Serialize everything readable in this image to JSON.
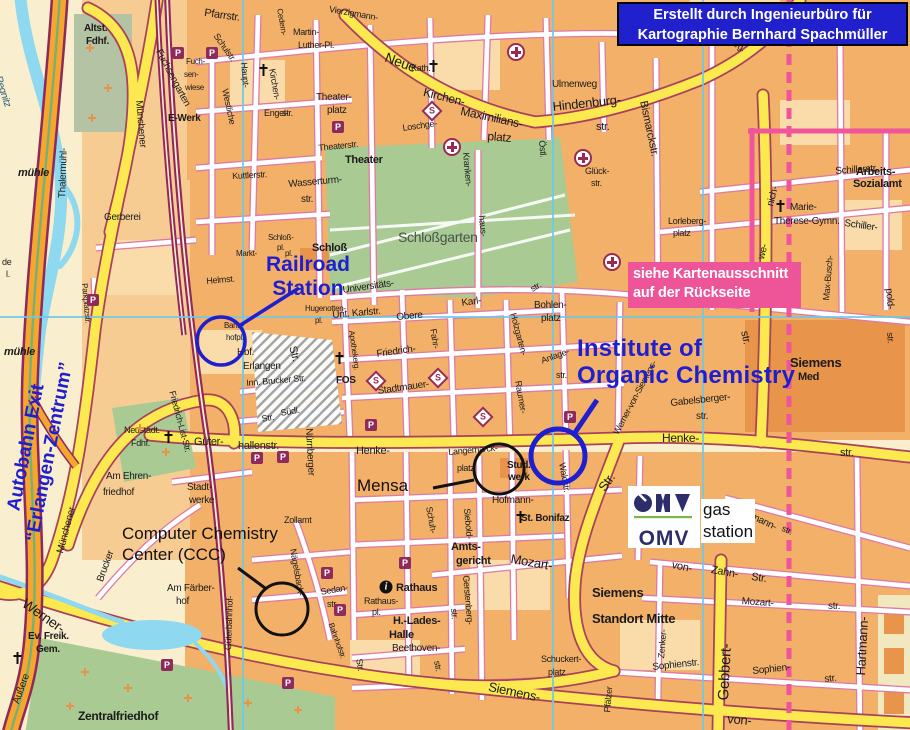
{
  "attribution": {
    "line1": "Erstellt durch Ingenieurbüro für",
    "line2": "Kartographie Bernhard Spachmüller"
  },
  "note": {
    "line1": "siehe Kartenausschnitt",
    "line2": "auf der Rückseite"
  },
  "annotations": {
    "railroad_station": {
      "line1": "Railroad",
      "line2": "Station"
    },
    "institute": {
      "line1": "Institute of",
      "line2": "Organic Chemistry"
    },
    "autobahn_exit": {
      "line1": "Autobahn Exit",
      "line2": "“Erlangen-Zentrum”"
    },
    "mensa": {
      "label": "Mensa"
    },
    "ccc": {
      "line1": "Computer Chemistry",
      "line2": "Center (CCC)"
    },
    "gas_station": {
      "line1": "gas",
      "line2": "station"
    },
    "omv": {
      "label": "OMV"
    }
  },
  "colors": {
    "annotation_blue": "#1F1FCF",
    "attribution_bg": "#2020CC",
    "note_pink": "#EE5598",
    "yellow_road": "#FBE94F",
    "block_orange": "#F3B068",
    "park_green": "#A9CB93",
    "river_blue": "#8ED9F0",
    "railway_maroon": "#93275C",
    "grid_blue": "#6EC9E9",
    "omv_navy": "#2D2D6B",
    "omv_green": "#7AB648"
  },
  "street_labels": [
    {
      "t": "Pfarrstr.",
      "x": 205,
      "y": 8,
      "s": 11,
      "r": 8
    },
    {
      "t": "Martin-",
      "x": 293,
      "y": 28,
      "s": 9
    },
    {
      "t": "Luther-Pl.",
      "x": 298,
      "y": 41,
      "s": 9
    },
    {
      "t": "Neue",
      "x": 388,
      "y": 50,
      "s": 14,
      "r": 20
    },
    {
      "t": "Vierzigmann-",
      "x": 330,
      "y": 5,
      "s": 9,
      "r": 10
    },
    {
      "t": "Cedern-",
      "x": 283,
      "y": 8,
      "s": 8,
      "r": 80
    },
    {
      "t": "Kath.",
      "x": 411,
      "y": 64,
      "s": 9
    },
    {
      "t": "Kirchen-",
      "x": 425,
      "y": 86,
      "s": 12,
      "r": 14
    },
    {
      "t": "Maximilians-",
      "x": 462,
      "y": 105,
      "s": 12,
      "r": 12
    },
    {
      "t": "platz",
      "x": 488,
      "y": 130,
      "s": 12,
      "r": 5
    },
    {
      "t": "Hindenburg-",
      "x": 552,
      "y": 100,
      "s": 13,
      "r": -6
    },
    {
      "t": "str.",
      "x": 596,
      "y": 122,
      "s": 11
    },
    {
      "t": "Ulmenweg",
      "x": 552,
      "y": 80,
      "s": 10
    },
    {
      "t": "Hinden-",
      "x": 688,
      "y": 22,
      "s": 9
    },
    {
      "t": "burg.",
      "x": 730,
      "y": 36,
      "s": 9,
      "r": 30
    },
    {
      "t": "Bismarckstr.",
      "x": 648,
      "y": 100,
      "s": 11,
      "r": 78
    },
    {
      "t": "Schillerstr.",
      "x": 835,
      "y": 167,
      "s": 10,
      "r": -4
    },
    {
      "t": "Arbeits-",
      "x": 856,
      "y": 167,
      "s": 11,
      "w": 700
    },
    {
      "t": "Sozialamt",
      "x": 853,
      "y": 179,
      "s": 11,
      "w": 700
    },
    {
      "t": "Schiller-",
      "x": 845,
      "y": 219,
      "s": 10,
      "r": 8
    },
    {
      "t": "Marie-",
      "x": 790,
      "y": 203,
      "s": 10
    },
    {
      "t": "Therese-Gymn.",
      "x": 774,
      "y": 217,
      "s": 10
    },
    {
      "t": "Lorleberg-",
      "x": 668,
      "y": 217,
      "s": 9
    },
    {
      "t": "platz",
      "x": 673,
      "y": 229,
      "s": 9
    },
    {
      "t": "Glück-",
      "x": 585,
      "y": 167,
      "s": 9
    },
    {
      "t": "str.",
      "x": 591,
      "y": 179,
      "s": 9
    },
    {
      "t": "Östl.",
      "x": 546,
      "y": 140,
      "s": 9,
      "r": 85
    },
    {
      "t": "Kranken-",
      "x": 470,
      "y": 152,
      "s": 9,
      "r": 85
    },
    {
      "t": "haus-",
      "x": 486,
      "y": 215,
      "s": 9,
      "r": 85
    },
    {
      "t": "Theater",
      "x": 345,
      "y": 155,
      "s": 11,
      "w": 700
    },
    {
      "t": "Theaterstr.",
      "x": 318,
      "y": 144,
      "s": 9,
      "r": -6
    },
    {
      "t": "Theater-",
      "x": 316,
      "y": 93,
      "s": 10
    },
    {
      "t": "platz",
      "x": 327,
      "y": 106,
      "s": 10
    },
    {
      "t": "Wasserturm-",
      "x": 288,
      "y": 180,
      "s": 10,
      "r": -5
    },
    {
      "t": "str.",
      "x": 301,
      "y": 195,
      "s": 10
    },
    {
      "t": "Kuttlerstr.",
      "x": 232,
      "y": 172,
      "s": 9,
      "r": -3
    },
    {
      "t": "Gerberei",
      "x": 104,
      "y": 213,
      "s": 10
    },
    {
      "t": "Schloßgarten",
      "x": 398,
      "y": 230,
      "s": 14,
      "c": "#47524a"
    },
    {
      "t": "Schloß",
      "x": 312,
      "y": 243,
      "s": 11,
      "w": 700
    },
    {
      "t": "Schloß-",
      "x": 268,
      "y": 234,
      "s": 8
    },
    {
      "t": "pl.",
      "x": 277,
      "y": 244,
      "s": 8
    },
    {
      "t": "Markt-",
      "x": 236,
      "y": 250,
      "s": 8
    },
    {
      "t": "pl.",
      "x": 285,
      "y": 250,
      "s": 8
    },
    {
      "t": "Helmst.",
      "x": 206,
      "y": 277,
      "s": 9,
      "r": -5
    },
    {
      "t": "Haupt-",
      "x": 248,
      "y": 62,
      "s": 9,
      "r": 85
    },
    {
      "t": "Kirchen-",
      "x": 276,
      "y": 68,
      "s": 9,
      "r": 80
    },
    {
      "t": "Engel-",
      "x": 264,
      "y": 109,
      "s": 9
    },
    {
      "t": "str.",
      "x": 282,
      "y": 109,
      "s": 9
    },
    {
      "t": "Schulstr.",
      "x": 219,
      "y": 32,
      "s": 9,
      "r": 55
    },
    {
      "t": "Westliche",
      "x": 229,
      "y": 88,
      "s": 9,
      "r": 78
    },
    {
      "t": "Fuchsengarten",
      "x": 162,
      "y": 48,
      "s": 10,
      "r": 62
    },
    {
      "t": "Fuch-",
      "x": 186,
      "y": 58,
      "s": 8
    },
    {
      "t": "sen-",
      "x": 184,
      "y": 71,
      "s": 8
    },
    {
      "t": "wiese",
      "x": 185,
      "y": 84,
      "s": 8
    },
    {
      "t": "E-Werk",
      "x": 168,
      "y": 114,
      "s": 10,
      "w": 700
    },
    {
      "t": "Altst.",
      "x": 84,
      "y": 24,
      "s": 10,
      "w": 700
    },
    {
      "t": "Fdhf.",
      "x": 86,
      "y": 37,
      "s": 10,
      "w": 700
    },
    {
      "t": "Münchener",
      "x": 143,
      "y": 100,
      "s": 10,
      "r": 85
    },
    {
      "t": "Thalermühl-",
      "x": 58,
      "y": 198,
      "s": 10,
      "r": -88
    },
    {
      "t": "mühle",
      "x": 18,
      "y": 168,
      "s": 11,
      "i": 1,
      "w": 700
    },
    {
      "t": "Regnitz",
      "x": 2,
      "y": 75,
      "s": 10,
      "r": 72,
      "i": 1,
      "c": "#2a5a7a"
    },
    {
      "t": "mühle",
      "x": 4,
      "y": 347,
      "s": 11,
      "i": 1,
      "w": 700
    },
    {
      "t": "Parkplatzstr.",
      "x": 88,
      "y": 283,
      "s": 8,
      "r": 85
    },
    {
      "t": "Bahn-",
      "x": 224,
      "y": 322,
      "s": 8
    },
    {
      "t": "hofpl.",
      "x": 226,
      "y": 334,
      "s": 8
    },
    {
      "t": "Hbf.",
      "x": 237,
      "y": 348,
      "s": 10
    },
    {
      "t": "Erlangen",
      "x": 243,
      "y": 362,
      "s": 10
    },
    {
      "t": "Hugenotten-",
      "x": 305,
      "y": 305,
      "s": 8
    },
    {
      "t": "pl.",
      "x": 315,
      "y": 317,
      "s": 8
    },
    {
      "t": "Universitäts-",
      "x": 342,
      "y": 286,
      "s": 10,
      "r": -8
    },
    {
      "t": "Unt. Karlstr.",
      "x": 332,
      "y": 311,
      "s": 10,
      "r": -5
    },
    {
      "t": "Obere",
      "x": 396,
      "y": 313,
      "s": 10,
      "r": -5
    },
    {
      "t": "Karl-",
      "x": 461,
      "y": 299,
      "s": 10,
      "r": -8
    },
    {
      "t": "str.",
      "x": 529,
      "y": 286,
      "s": 9,
      "r": -30
    },
    {
      "t": "Bohlen-",
      "x": 534,
      "y": 301,
      "s": 10
    },
    {
      "t": "platz",
      "x": 541,
      "y": 314,
      "s": 10
    },
    {
      "t": "Fahr-",
      "x": 437,
      "y": 328,
      "s": 9,
      "r": 80
    },
    {
      "t": "Friedrich-",
      "x": 376,
      "y": 350,
      "s": 10,
      "r": -8
    },
    {
      "t": "FOS",
      "x": 336,
      "y": 376,
      "s": 10,
      "w": 700
    },
    {
      "t": "Stadtmauer-",
      "x": 377,
      "y": 387,
      "s": 10,
      "r": -8
    },
    {
      "t": "Apothekerg.",
      "x": 355,
      "y": 330,
      "s": 8,
      "r": 82
    },
    {
      "t": "Str.",
      "x": 297,
      "y": 345,
      "s": 11,
      "r": 75
    },
    {
      "t": "Inn. Brucker Str.",
      "x": 246,
      "y": 379,
      "s": 9,
      "r": -5
    },
    {
      "t": "Südl.",
      "x": 280,
      "y": 409,
      "s": 9,
      "r": -10
    },
    {
      "t": "Str.",
      "x": 261,
      "y": 415,
      "s": 9,
      "r": -10
    },
    {
      "t": "Nürnberger",
      "x": 313,
      "y": 428,
      "s": 10,
      "r": 87
    },
    {
      "t": "Güter-",
      "x": 194,
      "y": 437,
      "s": 11
    },
    {
      "t": "hallenstr.",
      "x": 238,
      "y": 441,
      "s": 11
    },
    {
      "t": "Henke-",
      "x": 356,
      "y": 446,
      "s": 11
    },
    {
      "t": "Henke-",
      "x": 662,
      "y": 432,
      "s": 12
    },
    {
      "t": "str.",
      "x": 840,
      "y": 448,
      "s": 11
    },
    {
      "t": "str.",
      "x": 749,
      "y": 330,
      "s": 11,
      "r": 78
    },
    {
      "t": "Langemarck-",
      "x": 448,
      "y": 448,
      "s": 9,
      "r": -5
    },
    {
      "t": "platz",
      "x": 457,
      "y": 464,
      "s": 9
    },
    {
      "t": "Stud.-",
      "x": 507,
      "y": 461,
      "s": 10,
      "w": 700
    },
    {
      "t": "werk",
      "x": 508,
      "y": 473,
      "s": 10,
      "w": 700
    },
    {
      "t": "Hofmann-",
      "x": 492,
      "y": 496,
      "s": 10
    },
    {
      "t": "St. Bonifaz",
      "x": 521,
      "y": 514,
      "s": 10,
      "w": 700
    },
    {
      "t": "Siebold-",
      "x": 471,
      "y": 508,
      "s": 9,
      "r": 85
    },
    {
      "t": "Schuh-",
      "x": 433,
      "y": 506,
      "s": 9,
      "r": 80
    },
    {
      "t": "Amts-",
      "x": 451,
      "y": 542,
      "s": 11,
      "w": 700
    },
    {
      "t": "gericht",
      "x": 456,
      "y": 556,
      "s": 11,
      "w": 700
    },
    {
      "t": "Mozart-",
      "x": 512,
      "y": 552,
      "s": 13,
      "r": 10
    },
    {
      "t": "Gerstenberg-",
      "x": 470,
      "y": 575,
      "s": 9,
      "r": 85
    },
    {
      "t": "str.",
      "x": 458,
      "y": 608,
      "s": 9,
      "r": 85
    },
    {
      "t": "Rathaus",
      "x": 396,
      "y": 583,
      "s": 11,
      "w": 700
    },
    {
      "t": "Rathaus-",
      "x": 364,
      "y": 597,
      "s": 9
    },
    {
      "t": "pl.",
      "x": 372,
      "y": 608,
      "s": 9
    },
    {
      "t": "H.-Lades-",
      "x": 393,
      "y": 616,
      "s": 11,
      "w": 700
    },
    {
      "t": "Halle",
      "x": 389,
      "y": 630,
      "s": 11,
      "w": 700
    },
    {
      "t": "Beethoven-",
      "x": 392,
      "y": 644,
      "s": 10
    },
    {
      "t": "Str.",
      "x": 363,
      "y": 658,
      "s": 9,
      "r": 80
    },
    {
      "t": "str.",
      "x": 441,
      "y": 660,
      "s": 9,
      "r": 80
    },
    {
      "t": "Sedan-",
      "x": 320,
      "y": 588,
      "s": 9,
      "r": -10
    },
    {
      "t": "str.",
      "x": 327,
      "y": 600,
      "s": 9
    },
    {
      "t": "Bahnhofstr.",
      "x": 334,
      "y": 622,
      "s": 8,
      "r": 70
    },
    {
      "t": "Zollamt",
      "x": 284,
      "y": 516,
      "s": 9
    },
    {
      "t": "Nägelsbach-",
      "x": 297,
      "y": 548,
      "s": 9,
      "r": 80
    },
    {
      "t": "Güterbahnhof-",
      "x": 224,
      "y": 650,
      "s": 9,
      "r": -88
    },
    {
      "t": "Zentralfriedhof",
      "x": 78,
      "y": 710,
      "s": 12,
      "w": 700
    },
    {
      "t": "Ev. Freik.",
      "x": 28,
      "y": 632,
      "s": 10,
      "w": 700
    },
    {
      "t": "Gem.",
      "x": 36,
      "y": 645,
      "s": 10,
      "w": 700
    },
    {
      "t": "Äußere",
      "x": 12,
      "y": 702,
      "s": 10,
      "r": -70
    },
    {
      "t": "Werner-",
      "x": 28,
      "y": 596,
      "s": 14,
      "r": 35
    },
    {
      "t": "Brucker",
      "x": 96,
      "y": 580,
      "s": 10,
      "r": -70
    },
    {
      "t": "Münchener",
      "x": 56,
      "y": 552,
      "s": 10,
      "r": -75
    },
    {
      "t": "Am Ehren-",
      "x": 106,
      "y": 472,
      "s": 10
    },
    {
      "t": "friedhof",
      "x": 103,
      "y": 488,
      "s": 10
    },
    {
      "t": "Neustädt.",
      "x": 124,
      "y": 426,
      "s": 9
    },
    {
      "t": "Fdhf.",
      "x": 131,
      "y": 439,
      "s": 9
    },
    {
      "t": "Stadt-",
      "x": 187,
      "y": 483,
      "s": 10
    },
    {
      "t": "werke",
      "x": 189,
      "y": 496,
      "s": 10
    },
    {
      "t": "Friedrich-List-Str.",
      "x": 176,
      "y": 390,
      "s": 9,
      "r": 75
    },
    {
      "t": "Am Färber-",
      "x": 167,
      "y": 584,
      "s": 10
    },
    {
      "t": "hof",
      "x": 176,
      "y": 597,
      "s": 10
    },
    {
      "t": "Siemens-",
      "x": 490,
      "y": 680,
      "s": 13,
      "r": 12
    },
    {
      "t": "von-",
      "x": 728,
      "y": 712,
      "s": 13,
      "r": 5
    },
    {
      "t": "von-",
      "x": 673,
      "y": 560,
      "s": 11,
      "r": 12
    },
    {
      "t": "Zahn-",
      "x": 712,
      "y": 565,
      "s": 11,
      "r": 10
    },
    {
      "t": "Str.",
      "x": 752,
      "y": 572,
      "s": 11,
      "r": 8
    },
    {
      "t": "Mozart-",
      "x": 742,
      "y": 597,
      "s": 10,
      "r": 4
    },
    {
      "t": "str.",
      "x": 828,
      "y": 602,
      "s": 10
    },
    {
      "t": "Sophienstr.",
      "x": 652,
      "y": 663,
      "s": 10,
      "r": -6
    },
    {
      "t": "Sophien-",
      "x": 752,
      "y": 667,
      "s": 10,
      "r": -6
    },
    {
      "t": "str.",
      "x": 824,
      "y": 675,
      "s": 10,
      "r": -6
    },
    {
      "t": "Zenker-",
      "x": 657,
      "y": 658,
      "s": 9,
      "r": -85
    },
    {
      "t": "Pfälzer",
      "x": 603,
      "y": 712,
      "s": 9,
      "r": -85
    },
    {
      "t": "Gebbert-",
      "x": 716,
      "y": 700,
      "s": 15,
      "r": -87
    },
    {
      "t": "Hartmann-",
      "x": 854,
      "y": 675,
      "s": 13,
      "r": -87
    },
    {
      "t": "Siemens",
      "x": 592,
      "y": 586,
      "s": 13,
      "w": 700
    },
    {
      "t": "Standort Mitte",
      "x": 592,
      "y": 612,
      "s": 13,
      "w": 700
    },
    {
      "t": "Schuckert-",
      "x": 541,
      "y": 655,
      "s": 9
    },
    {
      "t": "platz",
      "x": 548,
      "y": 668,
      "s": 9
    },
    {
      "t": "Siemens",
      "x": 790,
      "y": 356,
      "s": 13,
      "w": 700
    },
    {
      "t": "Med",
      "x": 798,
      "y": 372,
      "s": 11,
      "w": 700
    },
    {
      "t": "Max-Busch-",
      "x": 822,
      "y": 300,
      "s": 9,
      "r": -85
    },
    {
      "t": "nich-",
      "x": 766,
      "y": 205,
      "s": 10,
      "r": -75
    },
    {
      "t": "we-",
      "x": 757,
      "y": 258,
      "s": 10,
      "r": -75
    },
    {
      "t": "pold-",
      "x": 893,
      "y": 288,
      "s": 10,
      "r": 85
    },
    {
      "t": "str.",
      "x": 894,
      "y": 332,
      "s": 9,
      "r": 85
    },
    {
      "t": "Hofmann-",
      "x": 740,
      "y": 506,
      "s": 10,
      "r": 25
    },
    {
      "t": "str.",
      "x": 784,
      "y": 524,
      "s": 9,
      "r": 25
    },
    {
      "t": "Waldstr.",
      "x": 566,
      "y": 462,
      "s": 9,
      "r": 80
    },
    {
      "t": "Str.",
      "x": 596,
      "y": 486,
      "s": 13,
      "r": -55
    },
    {
      "t": "de",
      "x": 2,
      "y": 258,
      "s": 9
    },
    {
      "t": "l.",
      "x": 6,
      "y": 270,
      "s": 9
    },
    {
      "t": "Raumer-",
      "x": 522,
      "y": 380,
      "s": 9,
      "r": 80
    },
    {
      "t": "Anlage-",
      "x": 540,
      "y": 357,
      "s": 9,
      "r": -20
    },
    {
      "t": "str.",
      "x": 556,
      "y": 371,
      "s": 9
    },
    {
      "t": "Holzgarten-",
      "x": 517,
      "y": 312,
      "s": 9,
      "r": 75
    },
    {
      "t": "Gabelsberger-",
      "x": 670,
      "y": 399,
      "s": 10,
      "r": -6
    },
    {
      "t": "str.",
      "x": 696,
      "y": 412,
      "s": 10
    },
    {
      "t": "Werner-von-Siemens-",
      "x": 612,
      "y": 432,
      "s": 9,
      "r": -62
    },
    {
      "t": "Loschge-",
      "x": 402,
      "y": 124,
      "s": 9,
      "r": -8
    }
  ],
  "icons": {
    "parking": {
      "glyph": "P",
      "points": [
        [
          178,
          53
        ],
        [
          212,
          53
        ],
        [
          338,
          127
        ],
        [
          93,
          300
        ],
        [
          371,
          425
        ],
        [
          257,
          458
        ],
        [
          283,
          457
        ],
        [
          570,
          417
        ],
        [
          405,
          563
        ],
        [
          167,
          665
        ],
        [
          288,
          683
        ],
        [
          327,
          573
        ],
        [
          340,
          610
        ]
      ]
    },
    "sbahn": {
      "glyph": "S",
      "points": [
        [
          432,
          111
        ],
        [
          376,
          381
        ],
        [
          438,
          378
        ],
        [
          483,
          417
        ]
      ]
    },
    "hospital": {
      "glyph": "",
      "points": [
        [
          516,
          52
        ],
        [
          452,
          147
        ],
        [
          583,
          158
        ],
        [
          612,
          262
        ]
      ]
    },
    "church": {
      "glyph": "",
      "points": [
        [
          263,
          70
        ],
        [
          433,
          66
        ],
        [
          339,
          358
        ],
        [
          168,
          437
        ],
        [
          520,
          517
        ],
        [
          17,
          658
        ],
        [
          780,
          206
        ]
      ]
    },
    "grave": {
      "glyph": "",
      "points": [
        [
          85,
          672
        ],
        [
          128,
          688
        ],
        [
          188,
          698
        ],
        [
          248,
          703
        ],
        [
          298,
          710
        ],
        [
          70,
          706
        ],
        [
          140,
          428
        ],
        [
          166,
          452
        ],
        [
          90,
          48
        ],
        [
          108,
          88
        ],
        [
          92,
          118
        ]
      ]
    },
    "info": {
      "glyph": "i",
      "points": [
        [
          386,
          587
        ]
      ]
    }
  }
}
